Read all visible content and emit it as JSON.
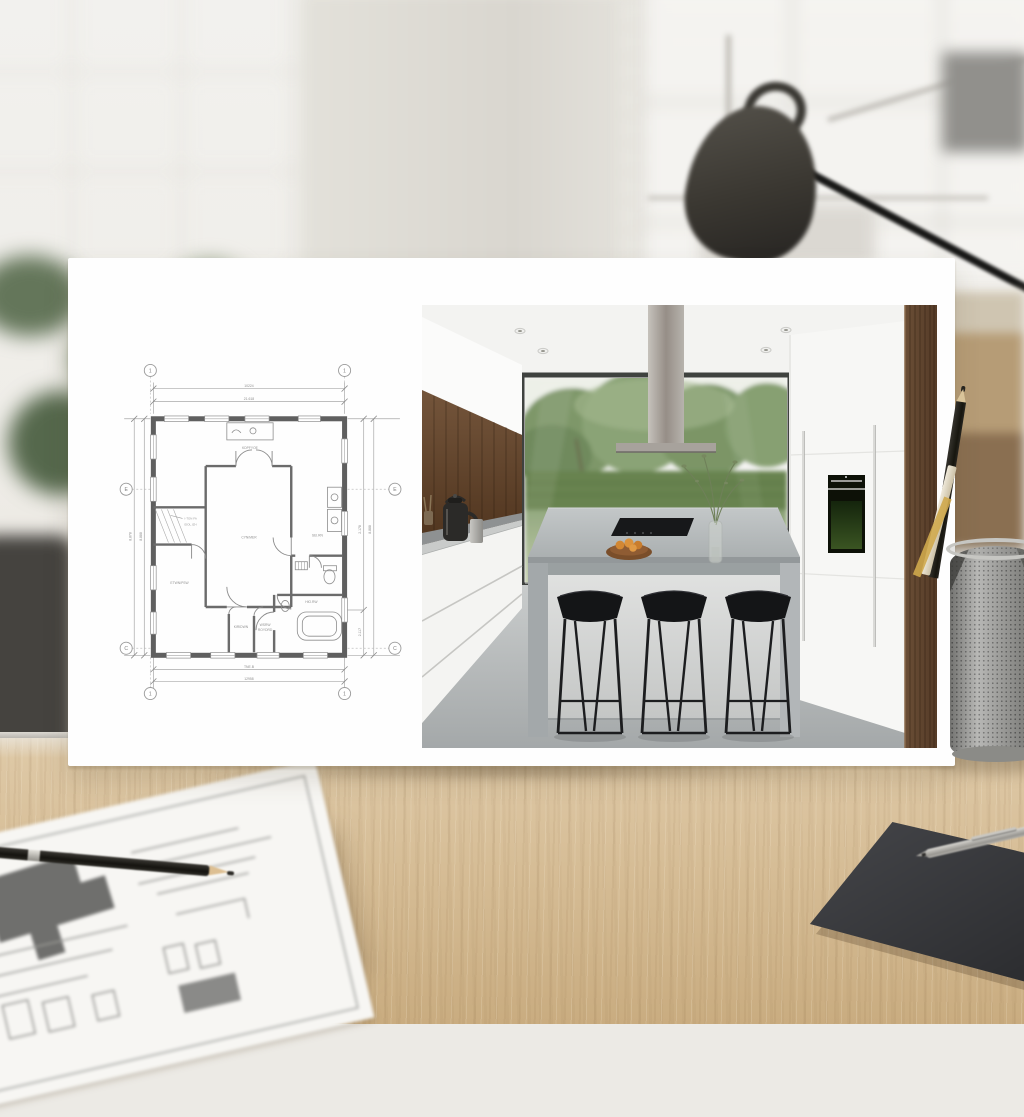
{
  "scene": {
    "setting": "architect desk with white presentation board, blurred bright interior behind",
    "board_left": "house floor plan drawing",
    "board_right": "photo render of modern kitchen with concrete island, three black bar stools, garden window",
    "props": [
      "black desk lamp",
      "green plant",
      "mesh pen cup with pencils",
      "sketch paper with black pencil",
      "dark desk mat with silver pen",
      "light wood desk"
    ]
  },
  "board": {
    "plan": {
      "grid": [
        "1",
        "1",
        "E",
        "E",
        "C",
        "C",
        "1",
        "1"
      ],
      "dims": {
        "top1": "10224",
        "top2": "21.618",
        "bottom1": "TNE.B",
        "bottom2": "12958",
        "left1": "8.878",
        "left2": "8.888",
        "right1": "2.178",
        "right2": "8.888",
        "right3": "2.117"
      },
      "rooms": {
        "top": "KDPFYOE",
        "center": "CYN/MER",
        "left": "ETWN/PSW",
        "bottom_mid": "KIRIDWN",
        "bottom_right1": "WSRW",
        "bottom_right2": "ROYDRD",
        "right_mid": "SEI.RN",
        "right_low": "HIO.RW",
        "callout1": "I-TON FA",
        "callout2": "EIOL.IZH"
      }
    },
    "kitchen": {
      "stool_count": 3,
      "island_items": [
        "wood fruit bowl with oranges",
        "glass vase with green sprigs",
        "black cooktop"
      ],
      "appliances": [
        "built-in black oven",
        "stainless island hood",
        "black kettle"
      ]
    }
  },
  "colors": {
    "card": "#fefefe",
    "desk_wood": "#d6bd96",
    "lamp": "#3a3731",
    "plant_green": "#6d8060",
    "plan_ink": "#6b6b6b",
    "garden_green": "#7e9769",
    "island_concrete": "#b7bcbd",
    "stool_black": "#141517",
    "walnut": "#5f452f",
    "fruit_orange": "#d28733"
  }
}
